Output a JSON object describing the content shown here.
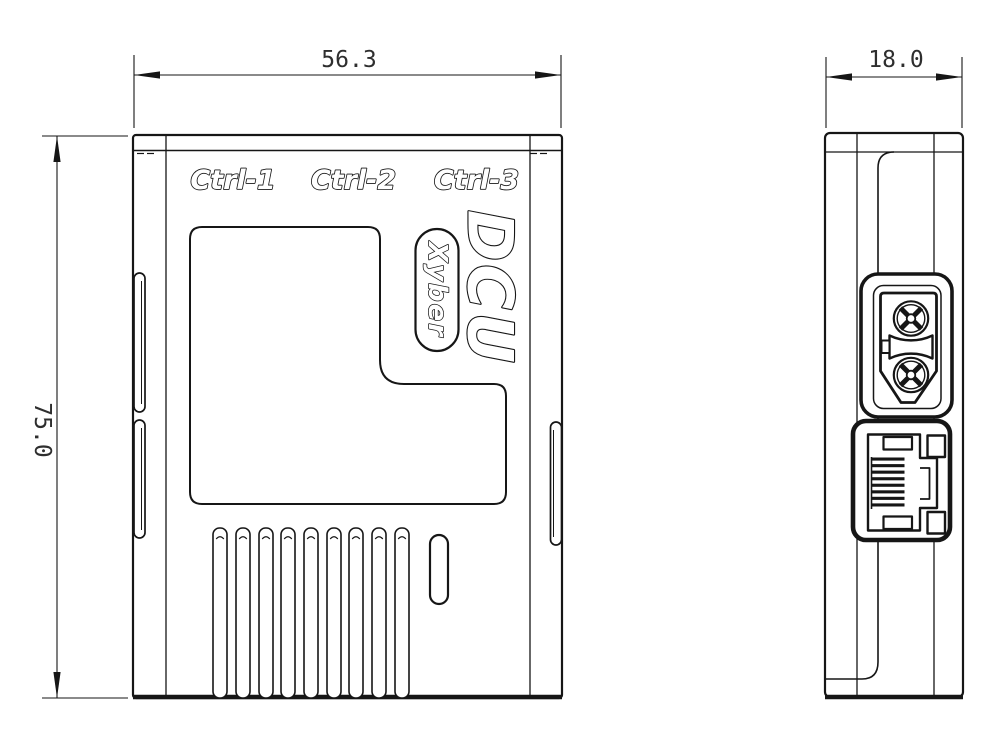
{
  "colors": {
    "line": "#161616",
    "background": "#ffffff",
    "dim_text": "#2e2e2e"
  },
  "front_view": {
    "port_labels": [
      "Ctrl-1",
      "Ctrl-2",
      "Ctrl-3"
    ],
    "product_name": "DCU",
    "brand": "Xyber",
    "vent_slot_count": 9,
    "width_dim": "56.3",
    "height_dim": "75.0"
  },
  "side_view": {
    "depth_dim": "18.0",
    "connector_icons": [
      "xt30-power-connector-icon",
      "rj45-ethernet-port-icon"
    ]
  }
}
